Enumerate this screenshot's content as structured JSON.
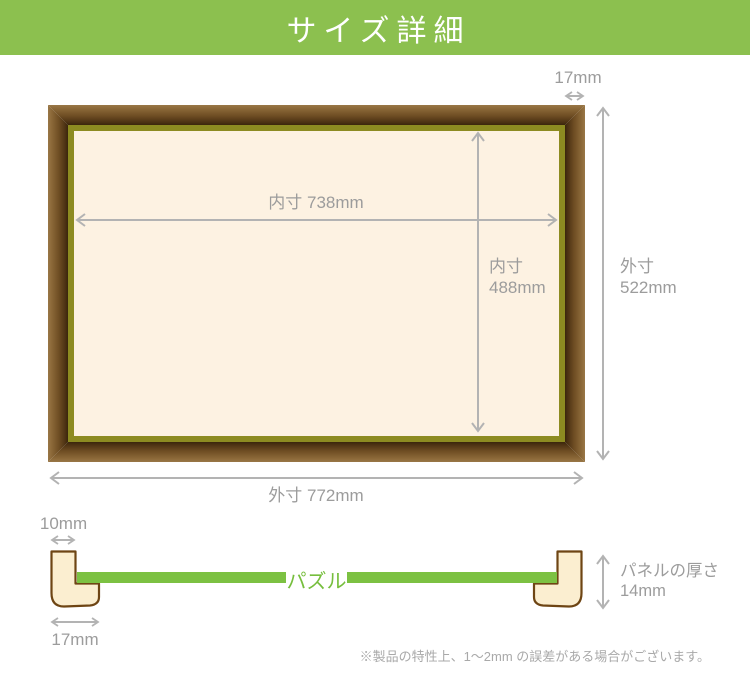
{
  "header": {
    "title": "サイズ詳細"
  },
  "frame": {
    "border_width_label": "17mm",
    "inner_width_label": "内寸 738mm",
    "inner_height_label": "内寸",
    "inner_height_value": "488mm",
    "outer_height_label": "外寸",
    "outer_height_value": "522mm",
    "outer_width_label": "外寸 772mm"
  },
  "cross_section": {
    "lip_width_label": "10mm",
    "base_width_label": "17mm",
    "puzzle_label": "パズル",
    "panel_thickness_label": "パネルの厚さ",
    "panel_thickness_value": "14mm"
  },
  "footer_note": "※製品の特性上、1～2mm の誤差がある場合がございます。",
  "colors": {
    "header_green": "#8CC04F",
    "puzzle_green": "#7CC142",
    "frame_brown_light": "#997747",
    "frame_brown_dark": "#3B260C",
    "liner_olive": "#8D8B21",
    "mat_cream": "#FDF2E2",
    "profile_cream": "#FBEED0",
    "profile_outline": "#6E4514",
    "dimension_gray": "#9C9C9C",
    "arrow_gray": "#B3B3B3"
  }
}
